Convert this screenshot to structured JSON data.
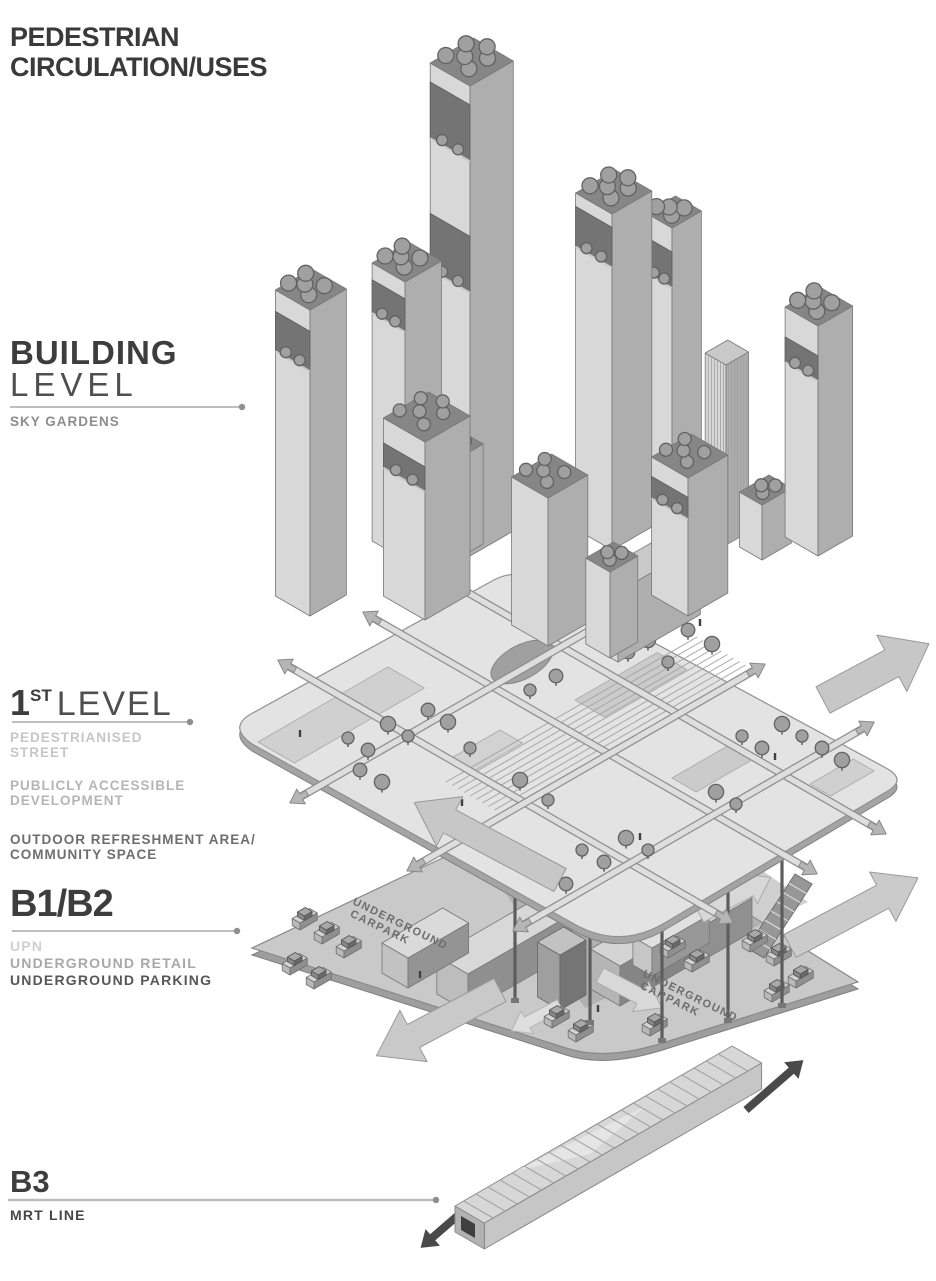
{
  "title": {
    "line1": "PEDESTRIAN",
    "line2": "CIRCULATION/USES"
  },
  "levels": {
    "building": {
      "heading": "BUILDING",
      "subheading": "LEVEL",
      "captions": [
        "SKY GARDENS"
      ]
    },
    "level1": {
      "number": "1",
      "ordinal": "ST",
      "subheading": "LEVEL",
      "caption_groups": [
        [
          "PEDESTRIANISED",
          "STREET"
        ],
        [
          "PUBLICLY ACCESSIBLE",
          "DEVELOPMENT"
        ],
        [
          "OUTDOOR REFRESHMENT AREA/",
          "COMMUNITY SPACE"
        ]
      ]
    },
    "b1b2": {
      "heading": "B1/B2",
      "captions": [
        "UPN",
        "UNDERGROUND RETAIL",
        "UNDERGROUND PARKING"
      ]
    },
    "b3": {
      "heading": "B3",
      "captions": [
        "MRT LINE"
      ]
    }
  },
  "diagram": {
    "carpark_left": [
      "UNDERGROUND",
      "CARPARK"
    ],
    "carpark_right": [
      "UNDERGROUND",
      "CARPARK"
    ]
  },
  "colors": {
    "ink": "#3d3d3d",
    "leader_line": "#a8a8a8",
    "tone_light": "#c6c6c6",
    "tone_mid": "#a8a8a8",
    "tone_dark": "#575757",
    "diagram_gray": "#c9c9c9"
  }
}
